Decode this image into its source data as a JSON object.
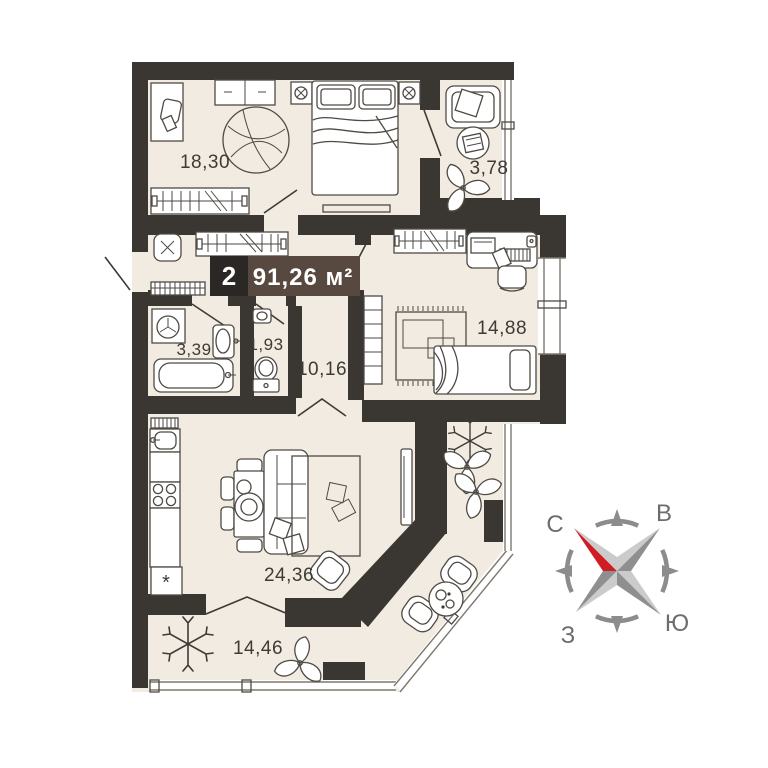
{
  "plan": {
    "label": {
      "rooms_count": "2",
      "area": "91,26 м²"
    },
    "rooms": [
      {
        "id": "bedroom-1",
        "area": "18,30"
      },
      {
        "id": "loggia-top",
        "area": "3,78"
      },
      {
        "id": "bedroom-2",
        "area": "14,88"
      },
      {
        "id": "bathroom",
        "area": "3,39"
      },
      {
        "id": "wc",
        "area": "1,93"
      },
      {
        "id": "hallway",
        "area": "10,16"
      },
      {
        "id": "living-kitchen",
        "area": "24,36"
      },
      {
        "id": "balcony",
        "area": "14,46"
      }
    ],
    "colors": {
      "wall": "#3a3733",
      "floor": "#f2ebe1",
      "label_bg": "#57493f",
      "label_number_bg": "#2b2724",
      "accent_red": "#d01c24",
      "compass_gray": "#8c8c8c"
    }
  },
  "compass": {
    "north": "С",
    "east": "В",
    "south": "Ю",
    "west": "З"
  }
}
